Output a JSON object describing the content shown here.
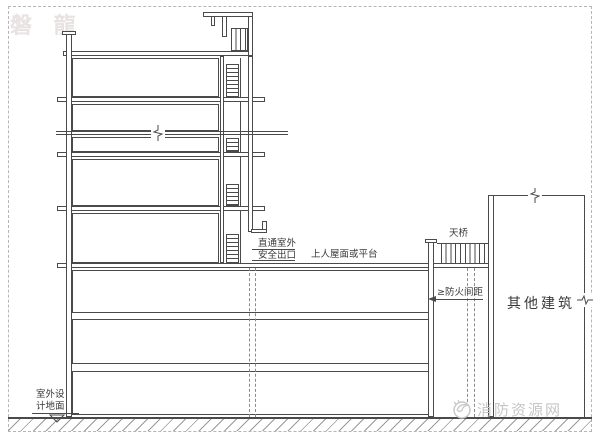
{
  "page": {
    "background": "#ffffff",
    "border_color": "#b6b6b6"
  },
  "colors": {
    "line": "#4a4a4a",
    "text": "#3a3a3a",
    "ground_hatch": "#9a9a9a",
    "watermark_top_left": "#e8e2e2",
    "watermark_bottom_right": "#c6c6c6"
  },
  "watermarks": {
    "top_left": "磐 龍",
    "bottom_right": "消防资源网"
  },
  "labels": {
    "exit_line1": "直通室外",
    "exit_line2": "安全出口",
    "roof_platform": "上人屋面或平台",
    "bridge": "天桥",
    "fire_distance": "≥防火间距",
    "other_building": "其他建筑",
    "ground_line1": "室外设",
    "ground_line2": "计地面"
  }
}
